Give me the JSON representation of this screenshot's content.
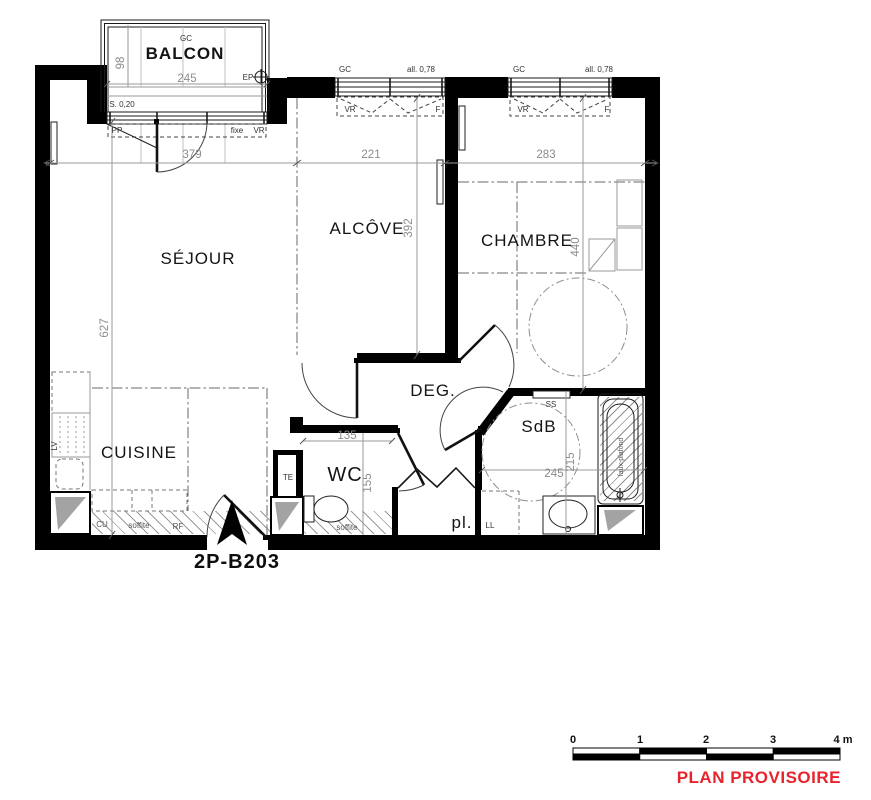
{
  "unit_label": "2P-B203",
  "status": {
    "label": "PLAN PROVISOIRE",
    "color": "#e8232b"
  },
  "scale_bar": {
    "ticks": [
      "0",
      "1",
      "2",
      "3",
      "4 m"
    ]
  },
  "rooms": {
    "balcon": "BALCON",
    "sejour": "SÉJOUR",
    "alcove": "ALCÔVE",
    "chambre": "CHAMBRE",
    "cuisine": "CUISINE",
    "wc": "WC",
    "deg": "DEG.",
    "sdb": "SdB",
    "placard": "pl."
  },
  "dims": {
    "balcon_width": "245",
    "balcon_depth": "98",
    "balcon_step": "S. 0,20",
    "sejour_width": "379",
    "sejour_depth": "627",
    "alcove_width": "221",
    "alcove_depth": "392",
    "chambre_width": "283",
    "chambre_depth": "440",
    "wc_width": "135",
    "wc_depth": "155",
    "sdb_width": "245",
    "sdb_depth": "215"
  },
  "labels": {
    "gc_balcon": "GC",
    "gc_alcove": "GC",
    "gc_chambre": "GC",
    "allege_alcove": "all. 0,78",
    "allege_chambre": "all. 0,78",
    "vr_window_alcove": "VR",
    "f_window_alcove": "F",
    "vr_window_chambre": "VR",
    "f_window_chambre": "F",
    "pp": "PP",
    "fixe": "fixe",
    "vr_balcon": "VR",
    "ep": "EP",
    "lv": "LV",
    "cu": "CU",
    "soffite_cuisine": "soffite",
    "rf": "RF",
    "te": "TE",
    "soffite_wc": "soffite",
    "ll": "LL",
    "ss": "SS",
    "faux_plafond": "faux-plafond"
  },
  "colors": {
    "wall": "#000000",
    "dim_text": "#8c8c8c"
  }
}
